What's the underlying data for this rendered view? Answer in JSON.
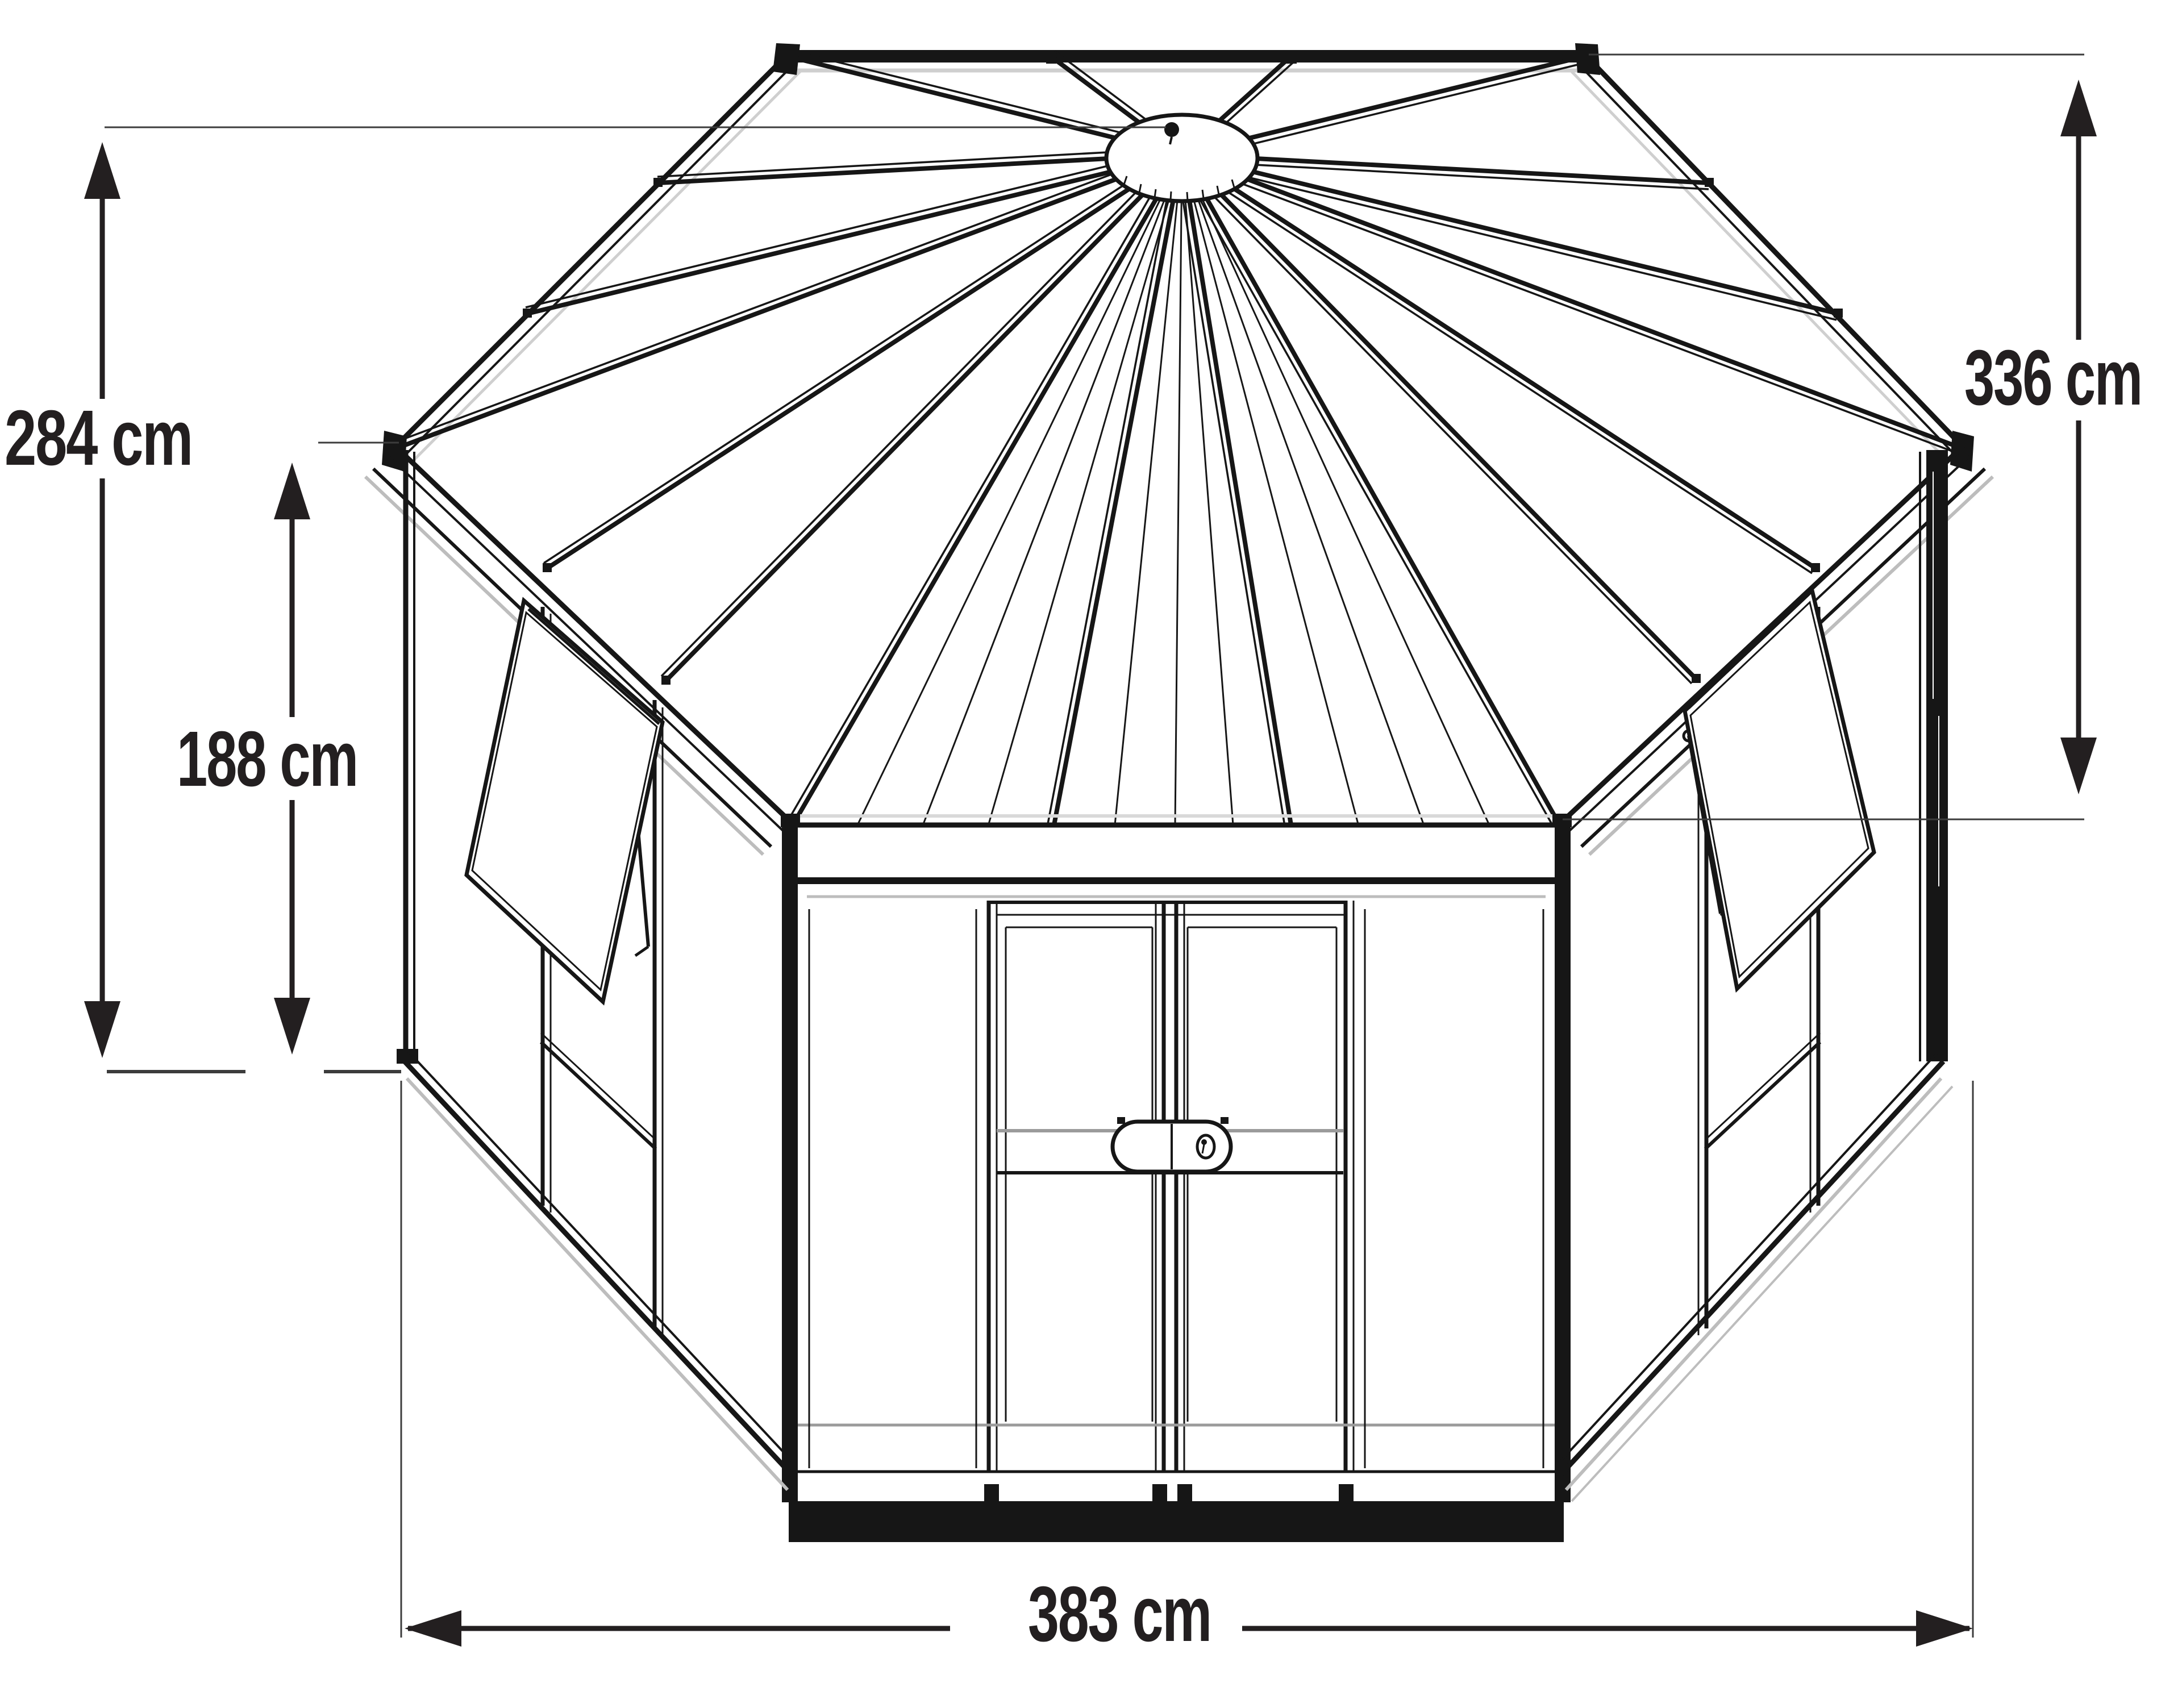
{
  "page": {
    "background": "#ffffff"
  },
  "diagram": {
    "type": "technical-line-drawing",
    "subject": "hexagonal greenhouse with conical glazed roof, two open awning windows and double front doors",
    "stroke_color": "#161616",
    "shadow_color": "#bdbdbd",
    "label_color": "#231f20"
  },
  "dimensions": {
    "overall_height": {
      "label": "284 cm",
      "value": 284,
      "unit": "cm",
      "orientation": "vertical",
      "position": "left-outer"
    },
    "wall_height": {
      "label": "188 cm",
      "value": 188,
      "unit": "cm",
      "orientation": "vertical",
      "position": "left-inner"
    },
    "depth": {
      "label": "336 cm",
      "value": 336,
      "unit": "cm",
      "orientation": "vertical",
      "position": "right"
    },
    "width": {
      "label": "383 cm",
      "value": 383,
      "unit": "cm",
      "orientation": "horizontal",
      "position": "bottom"
    }
  }
}
